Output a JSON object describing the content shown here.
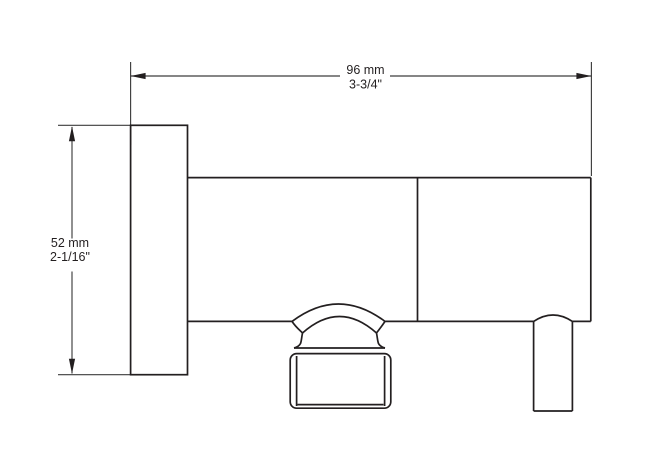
{
  "drawing": {
    "background_color": "#ffffff",
    "outline_color": "#231f20",
    "dimension_line_color": "#3d3d3d"
  },
  "annotations": {
    "width": {
      "metric": "96 mm",
      "imperial": "3-3/4\""
    },
    "height": {
      "metric": "52 mm",
      "imperial": "2-1/16\""
    }
  }
}
